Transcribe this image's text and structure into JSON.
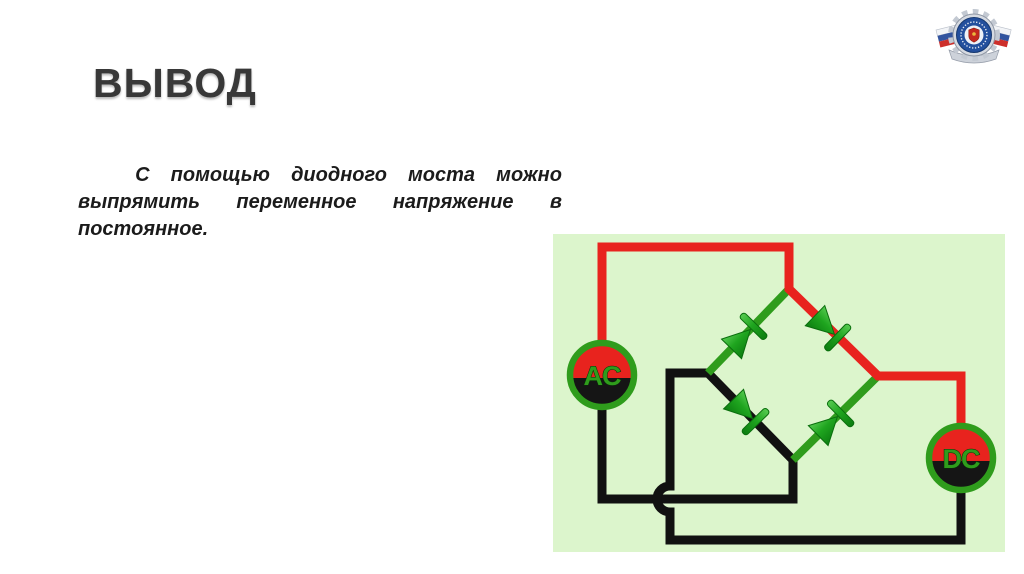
{
  "slide": {
    "title": "ВЫВОД",
    "paragraph": {
      "full_text": "С помощью диодного моста можно выпрямить переменное напряжение в постоянное.",
      "lines": [
        {
          "words": [
            "С",
            "помощью",
            "диодного",
            "моста",
            "можно"
          ],
          "justify": true,
          "indent": true
        },
        {
          "words": [
            "выпрямить",
            "переменное",
            "напряжение",
            "в"
          ],
          "justify": true,
          "indent": false
        },
        {
          "words": [
            "постоянное."
          ],
          "justify": false,
          "indent": false
        }
      ]
    }
  },
  "circuit": {
    "ac_label": "AC",
    "dc_label": "DC",
    "colors": {
      "panel_bg": "#dcf5cc",
      "wire_red": "#e8231e",
      "wire_black": "#111111",
      "wire_green": "#2f9c1c",
      "diode_light": "#58cb52",
      "diode_dark": "#0c7d10",
      "terminal_black": "#151515"
    }
  },
  "logo": {
    "ribbon_colors": [
      "#f2f4f7",
      "#32549f",
      "#cd2f2b"
    ],
    "emblem_blue": "#234f9d",
    "gear_gray": "#d6dae1"
  }
}
